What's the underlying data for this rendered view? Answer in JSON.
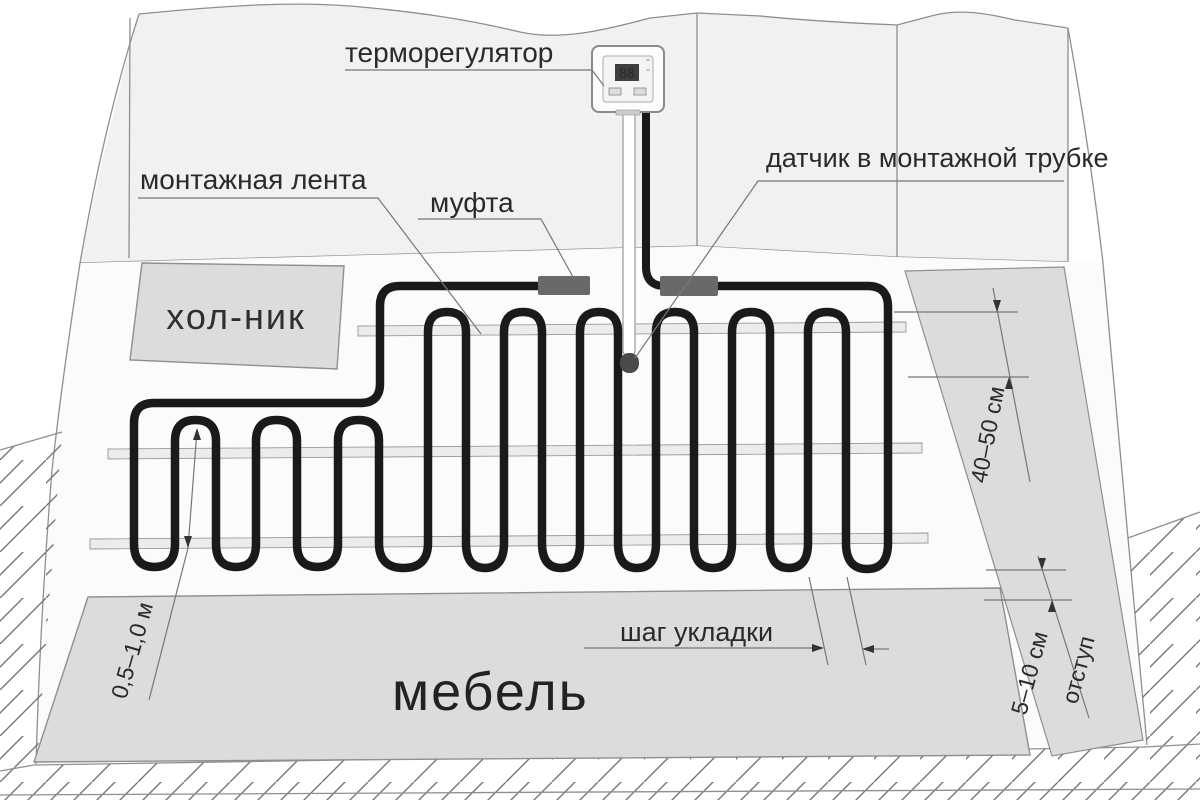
{
  "labels": {
    "thermostat": "терморегулятор",
    "mounting_tape": "монтажная лента",
    "coupling": "муфта",
    "sensor": "датчик в монтажной трубке",
    "fridge": "хол-ник",
    "furniture": "мебель",
    "laying_step": "шаг укладки"
  },
  "dimensions": {
    "wall_distance": "40–50 см",
    "edge_offset_value": "5–10 см",
    "edge_offset_word": "отступ",
    "furniture_distance": "0,5–1,0 м"
  },
  "thermostat": {
    "display": "88"
  },
  "colors": {
    "cable": "#1a1a1a",
    "coupling": "#696969",
    "zone_fill": "#dcdcdc",
    "tape_fill": "#ececec",
    "wall_fill": "#f1f1f1",
    "floor_fill": "#fbfbfb"
  }
}
